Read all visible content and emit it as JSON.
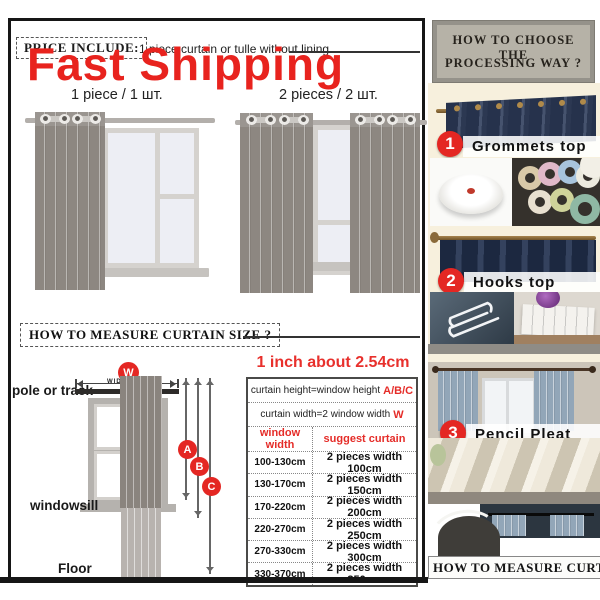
{
  "banner": {
    "fast_shipping": "Fast Shipping"
  },
  "price_include": {
    "label": "PRICE INCLUDE:",
    "note": "1 piece curtain or tulle without lining"
  },
  "variants": {
    "one": "1 piece  /  1 шт.",
    "two": "2 pieces  /  2 шт."
  },
  "measure": {
    "title": "HOW TO MEASURE  CURTAIN  SIZE ?",
    "pole_label": "pole or track",
    "windowsill_label": "windowsill",
    "floor_label": "Floor",
    "width_badge": "W",
    "width_caption": "WIDTH",
    "badge_a": "A",
    "badge_b": "B",
    "badge_c": "C"
  },
  "size_table": {
    "note": "1 inch about 2.54cm",
    "rule1_text": "curtain height=window height",
    "rule1_mark": "A/B/C",
    "rule2_text": "curtain width=2 window width",
    "rule2_mark": "W",
    "col1": "window width",
    "col2": "suggest curtain",
    "rows": [
      [
        "100-130cm",
        "2 pieces width 100cm"
      ],
      [
        "130-170cm",
        "2 pieces width 150cm"
      ],
      [
        "170-220cm",
        "2 pieces width 200cm"
      ],
      [
        "220-270cm",
        "2 pieces width 250cm"
      ],
      [
        "270-330cm",
        "2 pieces width 300cm"
      ],
      [
        "330-370cm",
        "2 pieces width 350cm"
      ]
    ]
  },
  "processing": {
    "title1": "HOW TO CHOOSE THE",
    "title2": "PROCESSING WAY ?",
    "step1_num": "1",
    "step1_label": "Grommets top",
    "step2_num": "2",
    "step2_label": "Hooks  top",
    "step3_num": "3",
    "step3_label": "Pencil  Pleat",
    "footer": "HOW TO MEASURE  CURTAI"
  },
  "colors": {
    "accent_red": "#e42723",
    "navy": "#2c3850",
    "cream": "#f7f0dd",
    "header_gray": "#95928a"
  }
}
